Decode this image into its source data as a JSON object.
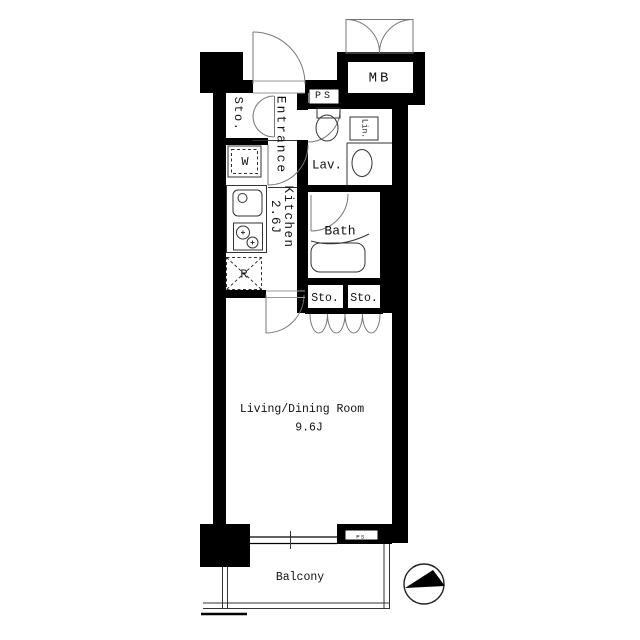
{
  "plan": {
    "title": "apartment-floorplan",
    "colors": {
      "wall": "#000000",
      "background": "#ffffff",
      "linework": "#333333",
      "door_arc": "#777777"
    },
    "rooms": {
      "meter_box": "MB",
      "pipe_space_top": "PS",
      "entrance": "Entrance",
      "storage_entrance": "Sto.",
      "washer": "W",
      "kitchen_name": "Kitchen",
      "kitchen_size": "2.6J",
      "fridge": "R",
      "lavatory": "Lav.",
      "linen": "Lin.",
      "bath": "Bath",
      "storage_hall_left": "Sto.",
      "storage_hall_right": "Sto.",
      "living_name": "Living/Dining Room",
      "living_size": "9.6J",
      "pipe_space_bottom": "PS",
      "balcony": "Balcony"
    }
  }
}
